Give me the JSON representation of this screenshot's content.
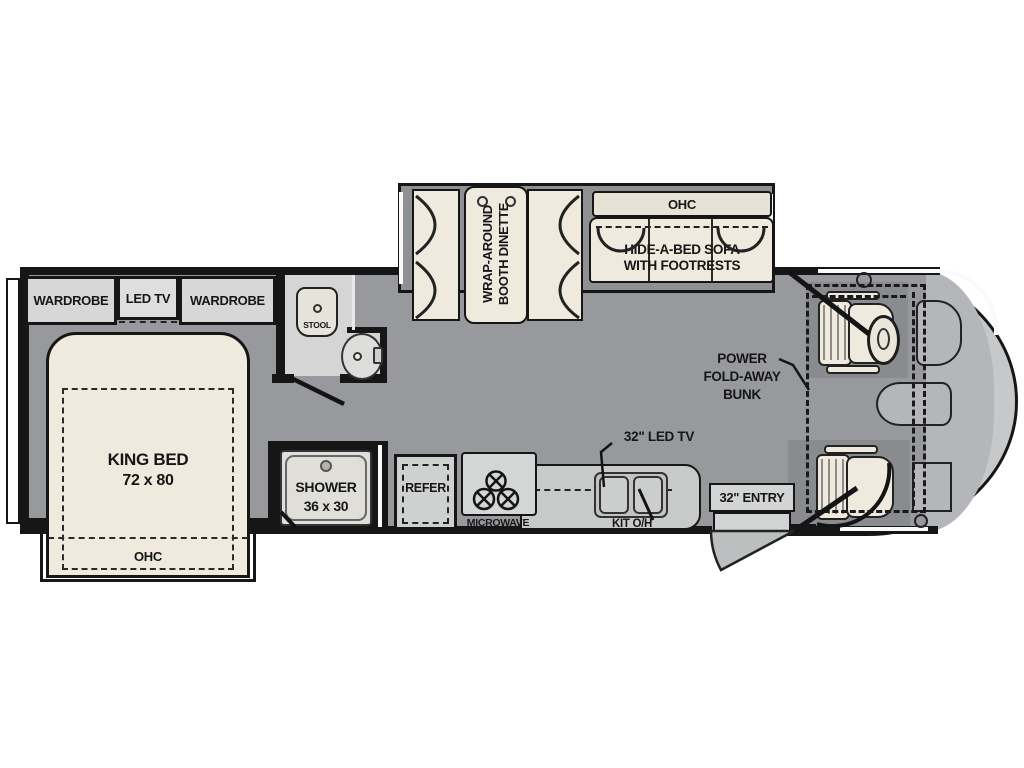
{
  "plan_title": "Class A motorhome floor plan",
  "colors": {
    "floor": "#97999c",
    "slide_floor": "#8e9093",
    "wall": "#161616",
    "furniture": "#efeadd",
    "cream_dark": "#e6e2d6",
    "cabinet": "#d7d7d7",
    "counter": "#c8caca",
    "appliance": "#d2d4d4",
    "bathroom_floor": "#d5d5d5",
    "cab_pad": "#898b8e",
    "cab_mid": "#b4b6b9",
    "nose": "#c6c8ca",
    "white_trim": "#ffffff",
    "text": "#161616"
  },
  "bedroom": {
    "wardrobe_left": "WARDROBE",
    "led_tv": "LED TV",
    "wardrobe_right": "WARDROBE",
    "bed_name": "KING BED",
    "bed_size": "72 x 80",
    "ohc": "OHC"
  },
  "bath": {
    "stool": "STOOL",
    "shower_name": "SHOWER",
    "shower_size": "36 x 30"
  },
  "dinette": {
    "line1": "WRAP-AROUND",
    "line2": "BOOTH DINETTE"
  },
  "sofa": {
    "ohc": "OHC",
    "line1": "HIDE-A-BED SOFA",
    "line2": "WITH FOOTRESTS"
  },
  "kitchen": {
    "refer": "REFER",
    "microwave": "MICROWAVE",
    "kit_oh": "KIT O/H",
    "tv": "32\" LED TV"
  },
  "front": {
    "entry": "32\" ENTRY",
    "bunk1": "POWER",
    "bunk2": "FOLD-AWAY",
    "bunk3": "BUNK"
  }
}
